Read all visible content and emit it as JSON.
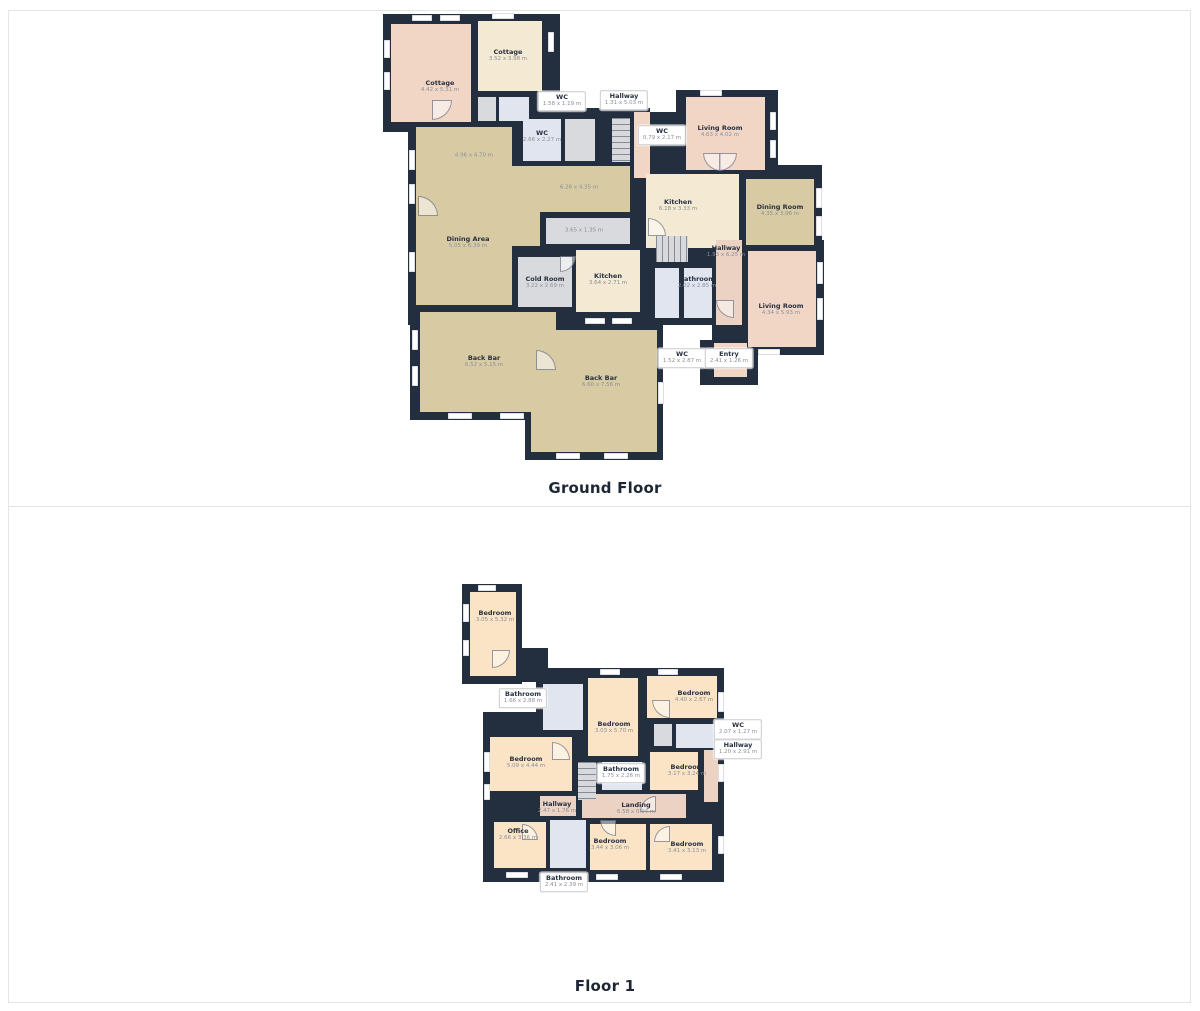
{
  "palette": {
    "wall": "#232e3f",
    "beige": "#d8cba4",
    "cream": "#f4e9d2",
    "pink": "#f1d6c6",
    "pinkd": "#ecd2c2",
    "peach": "#fbe4c5",
    "blue": "#e0e5f0",
    "gray": "#d8dade",
    "label_name": "#273142",
    "label_dims": "#8a8f99",
    "section_border": "#e4e4e4"
  },
  "floors": [
    {
      "id": "ground",
      "title": "Ground Floor",
      "rooms": [
        {
          "id": "cottage-left",
          "name": "Cottage",
          "dims": "4.42 x 5.31 m"
        },
        {
          "id": "cottage-right",
          "name": "Cottage",
          "dims": "3.52 x 3.98 m"
        },
        {
          "id": "wc-top",
          "name": "WC",
          "dims": "1.58 x 1.19 m"
        },
        {
          "id": "hallway-top",
          "name": "Hallway",
          "dims": "1.31 x 5.03 m"
        },
        {
          "id": "wc-narrow",
          "name": "WC",
          "dims": "0.79 x 2.17 m"
        },
        {
          "id": "wc-mid",
          "name": "WC",
          "dims": "2.66 x 2.27 m"
        },
        {
          "id": "dining-upper",
          "name": "",
          "dims": "4.96 x 4.70 m"
        },
        {
          "id": "dining-ext",
          "name": "",
          "dims": "6.26 x 4.35 m"
        },
        {
          "id": "corridor",
          "name": "",
          "dims": "3.65 x 1.35 m"
        },
        {
          "id": "dining-area",
          "name": "Dining Area",
          "dims": "5.05 x 6.39 m"
        },
        {
          "id": "cold-room",
          "name": "Cold Room",
          "dims": "3.22 x 2.69 m"
        },
        {
          "id": "kitchen-mid",
          "name": "Kitchen",
          "dims": "3.64 x 2.71 m"
        },
        {
          "id": "living-top",
          "name": "Living Room",
          "dims": "4.63 x 4.02 m"
        },
        {
          "id": "kitchen-right",
          "name": "Kitchen",
          "dims": "6.18 x 3.33 m"
        },
        {
          "id": "dining-room",
          "name": "Dining Room",
          "dims": "4.35 x 3.96 m"
        },
        {
          "id": "hallway-right",
          "name": "Hallway",
          "dims": "1.93 x 6.25 m"
        },
        {
          "id": "bathroom",
          "name": "Bathroom",
          "dims": "2.02 x 2.85 m"
        },
        {
          "id": "living-bottom",
          "name": "Living Room",
          "dims": "4.34 x 5.93 m"
        },
        {
          "id": "wc-bottom",
          "name": "WC",
          "dims": "1.52 x 2.87 m"
        },
        {
          "id": "entry",
          "name": "Entry",
          "dims": "2.41 x 1.26 m"
        },
        {
          "id": "back-bar-left",
          "name": "Back Bar",
          "dims": "6.52 x 5.15 m"
        },
        {
          "id": "back-bar-right",
          "name": "Back Bar",
          "dims": "6.60 x 7.56 m"
        }
      ]
    },
    {
      "id": "first",
      "title": "Floor 1",
      "rooms": [
        {
          "id": "bedroom-tl",
          "name": "Bedroom",
          "dims": "3.05 x 5.32 m"
        },
        {
          "id": "bathroom-top",
          "name": "Bathroom",
          "dims": "1.66 x 2.88 m"
        },
        {
          "id": "bedroom-mid",
          "name": "Bedroom",
          "dims": "3.03 x 5.70 m"
        },
        {
          "id": "bedroom-tr",
          "name": "Bedroom",
          "dims": "4.40 x 2.67 m"
        },
        {
          "id": "wc",
          "name": "WC",
          "dims": "2.07 x 1.27 m"
        },
        {
          "id": "hallway-right",
          "name": "Hallway",
          "dims": "1.20 x 2.91 m"
        },
        {
          "id": "bedroom-left",
          "name": "Bedroom",
          "dims": "5.09 x 4.44 m"
        },
        {
          "id": "bathroom-mid",
          "name": "Bathroom",
          "dims": "1.75 x 2.26 m"
        },
        {
          "id": "bedroom-right",
          "name": "Bedroom",
          "dims": "3.17 x 3.24 m"
        },
        {
          "id": "hallway",
          "name": "Hallway",
          "dims": "2.47 x 1.76 m"
        },
        {
          "id": "landing",
          "name": "Landing",
          "dims": "6.58 x 0.94 m"
        },
        {
          "id": "office",
          "name": "Office",
          "dims": "2.66 x 3.36 m"
        },
        {
          "id": "bathroom-bottom",
          "name": "Bathroom",
          "dims": "2.41 x 2.39 m"
        },
        {
          "id": "bedroom-bottom-mid",
          "name": "Bedroom",
          "dims": "3.44 x 3.06 m"
        },
        {
          "id": "bedroom-bottom-right",
          "name": "Bedroom",
          "dims": "3.41 x 3.13 m"
        }
      ]
    }
  ]
}
